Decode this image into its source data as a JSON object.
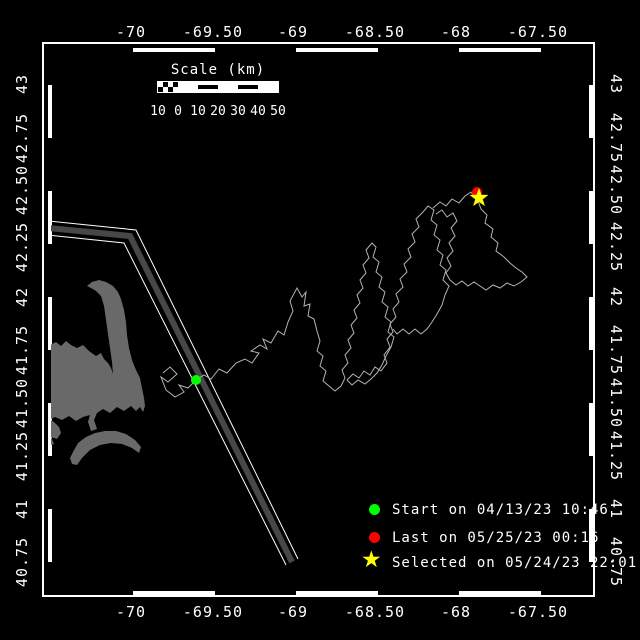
{
  "axes": {
    "top": [
      "-70",
      "-69.50",
      "-69",
      "-68.50",
      "-68",
      "-67.50"
    ],
    "bottom": [
      "-70",
      "-69.50",
      "-69",
      "-68.50",
      "-68",
      "-67.50"
    ],
    "left": [
      "43",
      "42.75",
      "42.50",
      "42.25",
      "42",
      "41.75",
      "41.50",
      "41.25",
      "41",
      "40.75"
    ],
    "right": [
      "43",
      "42.75",
      "42.50",
      "42.25",
      "42",
      "41.75",
      "41.50",
      "41.25",
      "41",
      "40.75"
    ]
  },
  "scale_bar": {
    "title": "Scale (km)",
    "tick_labels": [
      "10",
      "0",
      "10",
      "20",
      "30",
      "40",
      "50"
    ]
  },
  "legend": {
    "star_glyph": "★",
    "items": [
      {
        "marker": "start-dot",
        "color": "#00ff00",
        "label": "Start on 04/13/23 10:46"
      },
      {
        "marker": "last-dot",
        "color": "#ff0000",
        "label": "Last on 05/25/23 00:16"
      },
      {
        "marker": "selected-star",
        "color": "#ffff00",
        "label": "Selected on 05/24/23 22:01"
      }
    ]
  },
  "colors": {
    "background": "#000000",
    "frame": "#ffffff",
    "track": "#b4b4b4",
    "land": "#696969",
    "lane_fill": "#474747",
    "lane_edge": "#ffffff",
    "start_green": "#00ff00",
    "last_red": "#ff0000",
    "selected_yellow": "#ffff00"
  },
  "map_geometry": {
    "land": {
      "cape_cod": "87,286 92,282 99,280 106,282 113,286 118,292 121,299 124,310 126,322 127,335 129,348 132,360 136,370 140,378 142,388 144,398 145,406 143,412 140,407 136,411 131,406 124,411 117,407 110,413 103,409 97,413 94,420 97,429 91,431 88,422 90,415 83,417 76,421 69,416 62,420 55,417 49,420 43,419 43,348 50,345 56,342 61,346 66,341 71,345 77,348 83,345 89,351 96,356 101,353 104,359 108,363 111,368 113,374 112,362 110,348 108,334 106,320 104,306 101,296 96,291 91,288",
      "marthas_vineyard": "43,421 49,419 54,422 59,427 61,433 57,439 51,437 54,444 47,446 43,443",
      "nantucket": "73,452 78,443 86,437 95,433 105,431 116,431 126,434 135,440 141,447 139,453 132,448 122,444 111,443 100,445 90,450 82,458 77,465 72,464 70,458"
    },
    "shipping_lane": {
      "center": "48,228 130,236 292,562",
      "edge1": "48,221 136,230 298,559",
      "edge2": "48,235 124,243 286,565",
      "fill_width": "6"
    },
    "track": {
      "seg1": "163,373 170,367 177,374 168,382 161,377 166,390 175,397 184,392 179,385 188,388 196,380 204,375 211,379 219,369 227,373 236,363 245,359 252,363 259,353 251,351 260,345 267,349 263,339 271,343 278,331 284,335 288,322 293,311 290,301 297,288 302,297 306,292 304,306 310,304 308,316 314,319 317,331 320,341 317,351 323,356 320,366 326,371 323,381 329,386 335,391 341,386 345,378 342,370 348,363 345,355 351,348 348,340 354,333 351,325 357,318 354,310 360,303 357,295 363,288 360,280 366,273 363,265 369,258 366,250 372,243 376,247 373,257 379,262 376,272 382,277 379,287 385,292 382,302 388,307 385,317 391,322 388,332 394,337 391,347 386,356 382,365 377,373 371,379 365,384 358,380 352,385 347,380",
      "seg2": "347,380 353,374 359,378 364,371 370,375 375,367 381,371 387,363 384,355 390,347 387,339 393,332 390,324 396,317 393,309 399,302 396,294 403,287 400,279 407,272 404,264 411,257 408,249 415,242 412,234 419,227 416,219 423,212 428,206 434,210 431,220 437,225 434,235 440,240 437,250 443,255 440,265 446,270 443,280 449,286 445,295 442,305 437,314 432,322 427,329 421,334 415,329 409,334 403,329 397,334 393,329",
      "seg3": "433,208 440,202 446,206 452,199 459,203 465,196 471,192 474,196 478,201 481,209 487,215 485,223 493,229 491,237 498,243 496,251 504,257 510,263 516,268 522,272 527,277 521,282 514,286 507,283 500,288 493,285 486,290 480,286 474,282 468,286 462,281 456,285 450,280 446,273 451,266 447,258 453,251 449,243 455,236 451,228 457,221 453,213 447,217 442,210 436,214"
    },
    "markers": {
      "start": {
        "cx": "196",
        "cy": "380",
        "r": "5"
      },
      "last": {
        "cx": "477",
        "cy": "192",
        "r": "5"
      },
      "selected_star_points": "479,188 481.4,194.8 488.5,194.9 482.8,199.2 484.9,206.1 479,202 473.1,206.1 475.2,199.2 469.5,194.9 476.6,194.8"
    }
  }
}
